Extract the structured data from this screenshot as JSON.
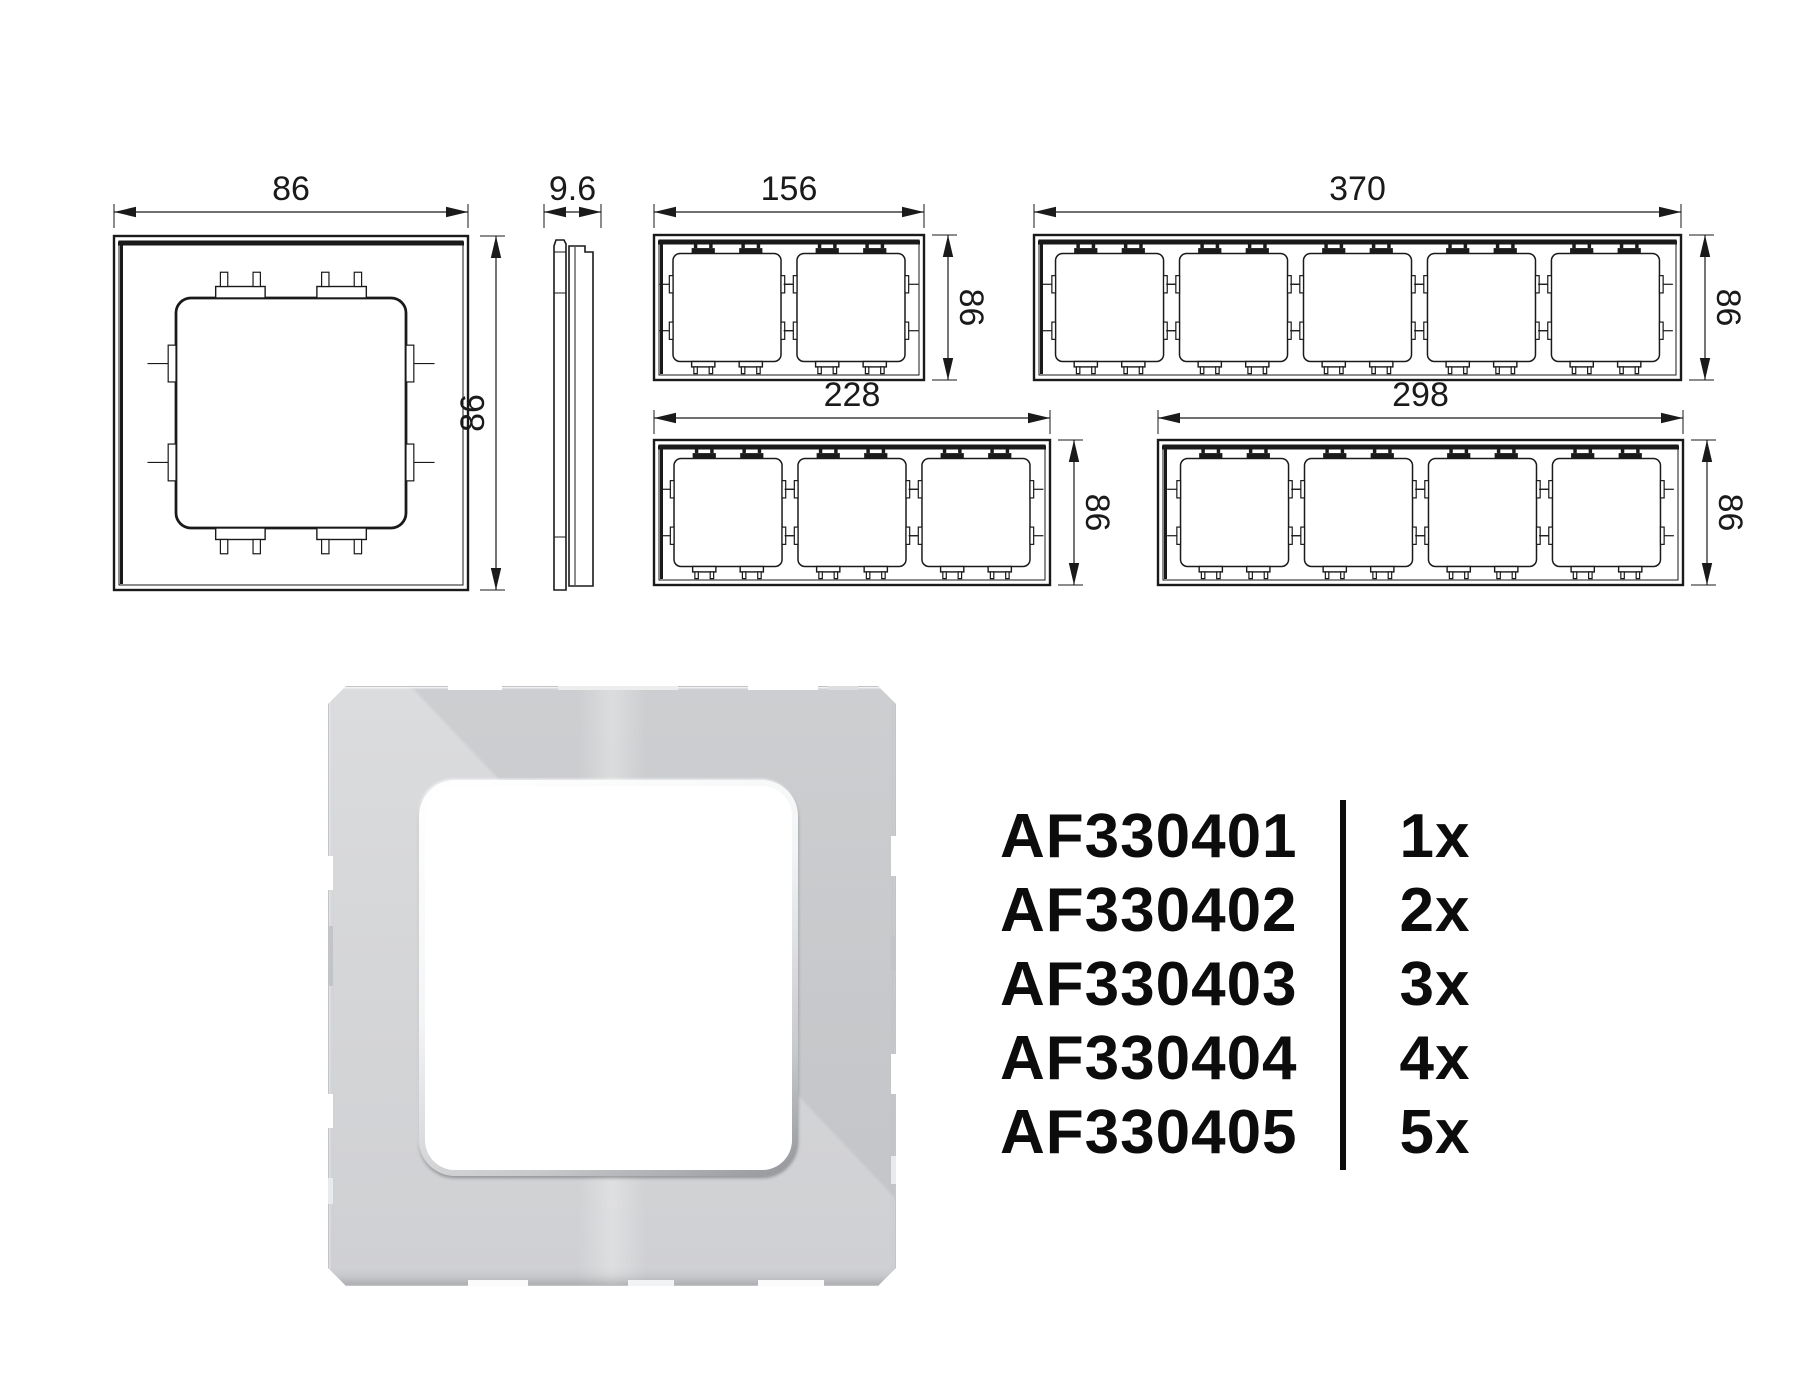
{
  "meta": {
    "background": "#ffffff",
    "line_color": "#1a1a1a",
    "text_color": "#0c0c0c"
  },
  "drawings": {
    "front_view": {
      "name": "single-frame-front-view",
      "gangs": 1,
      "dim_width": "86",
      "dim_height": "86"
    },
    "side_view": {
      "name": "frame-side-profile",
      "dim_thickness": "9.6"
    },
    "frames": [
      {
        "gangs": 2,
        "dim_width": "156",
        "dim_height": "86"
      },
      {
        "gangs": 5,
        "dim_width": "370",
        "dim_height": "86"
      },
      {
        "gangs": 3,
        "dim_width": "228",
        "dim_height": "86"
      },
      {
        "gangs": 4,
        "dim_width": "298",
        "dim_height": "86"
      }
    ]
  },
  "product_photo": {
    "description": "1-gang glass frame render",
    "body_color": "#d4d5d7",
    "window_color": "#ffffff"
  },
  "parts_list": [
    {
      "code": "AF330401",
      "qty": "1x"
    },
    {
      "code": "AF330402",
      "qty": "2x"
    },
    {
      "code": "AF330403",
      "qty": "3x"
    },
    {
      "code": "AF330404",
      "qty": "4x"
    },
    {
      "code": "AF330405",
      "qty": "5x"
    }
  ]
}
